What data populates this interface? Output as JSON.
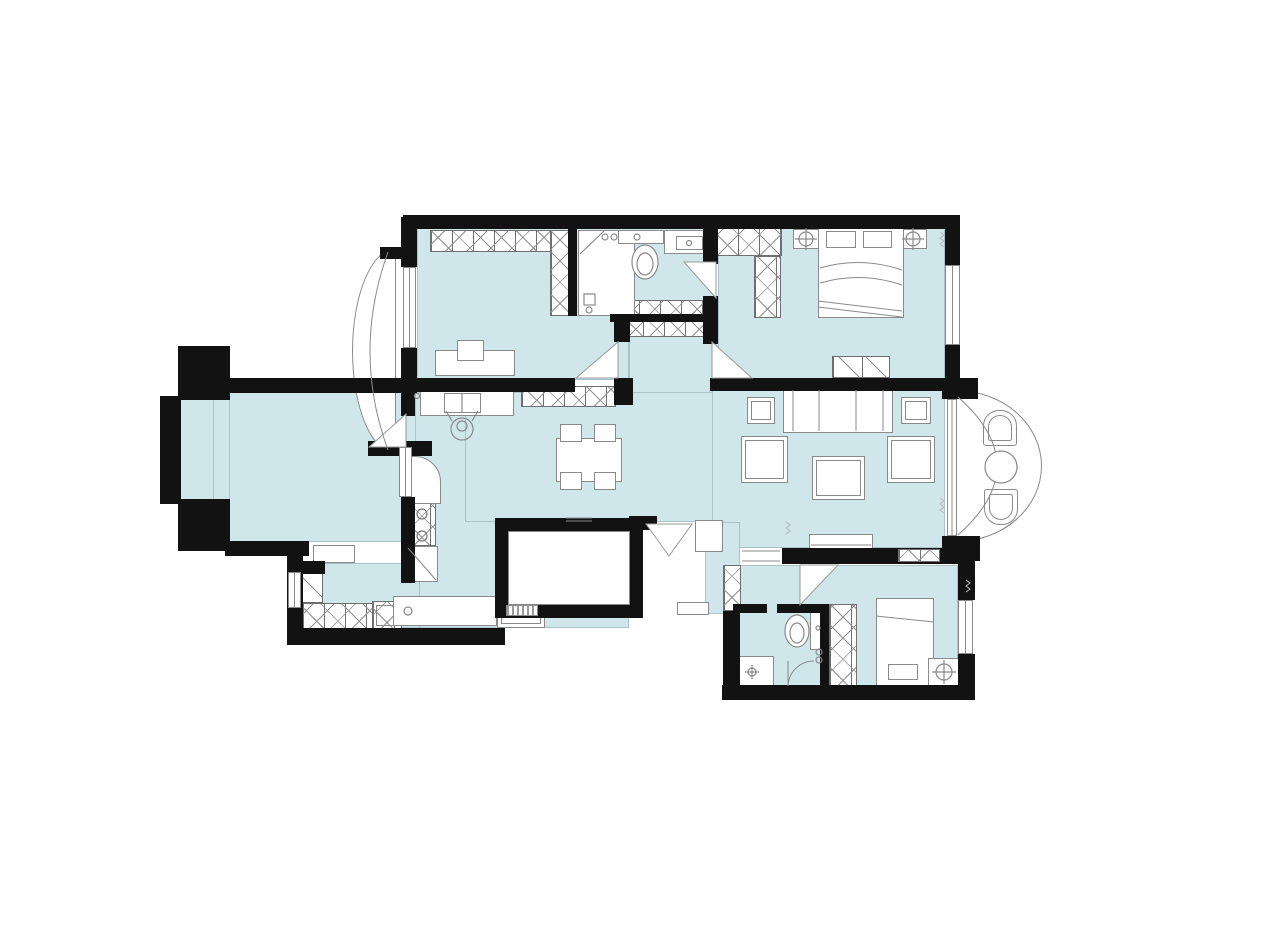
{
  "title": "Residential apartment floor plan",
  "colors": {
    "bg": "#ffffff",
    "floor": "#cfe7eb",
    "wall": "#121212",
    "line": "#8a8a8a",
    "linelight": "#b9b9b9"
  },
  "rooms": [
    {
      "id": "study",
      "furniture": [
        "wardrobe",
        "desk",
        "monitor"
      ]
    },
    {
      "id": "bathroom",
      "furniture": [
        "shower-stall",
        "toilet",
        "vanity-sink",
        "cabinet"
      ]
    },
    {
      "id": "master-bedroom",
      "furniture": [
        "l-wardrobe",
        "double-bed",
        "nightstand-left",
        "nightstand-right",
        "bench"
      ]
    },
    {
      "id": "left-bedroom",
      "furniture": []
    },
    {
      "id": "left-bay-window",
      "furniture": []
    },
    {
      "id": "kitchen",
      "furniture": [
        "sink-counter",
        "stool",
        "curved-counter",
        "stove",
        "base-cabinet",
        "work-counter",
        "washing-machine"
      ]
    },
    {
      "id": "dining-room",
      "furniture": [
        "sideboard",
        "dining-table",
        "chair",
        "chair",
        "chair",
        "chair"
      ]
    },
    {
      "id": "living-room",
      "furniture": [
        "sofa",
        "side-table-left",
        "side-table-right",
        "armchair-left",
        "armchair-right",
        "coffee-table",
        "tv-console",
        "wall-niche-cabinet"
      ]
    },
    {
      "id": "right-bay-window",
      "furniture": [
        "lounge-chair",
        "round-table",
        "lounge-chair"
      ]
    },
    {
      "id": "second-bedroom",
      "furniture": [
        "single-bed",
        "pillow",
        "nightstand",
        "wardrobe"
      ]
    },
    {
      "id": "ensuite-bathroom",
      "furniture": [
        "toilet",
        "vanity-sink",
        "shower"
      ]
    },
    {
      "id": "utility-balcony",
      "furniture": [
        "side-cabinet",
        "low-cabinet",
        "fridge"
      ]
    },
    {
      "id": "entry",
      "furniture": [
        "double-entry-door",
        "shoe-cabinet",
        "step"
      ]
    },
    {
      "id": "stairwell",
      "furniture": []
    }
  ],
  "icons": [
    "toilet-icon",
    "shower-head-icon",
    "lamp-icon",
    "burner-icon",
    "person-at-sink-icon",
    "door-swing-icon",
    "window-icon"
  ]
}
